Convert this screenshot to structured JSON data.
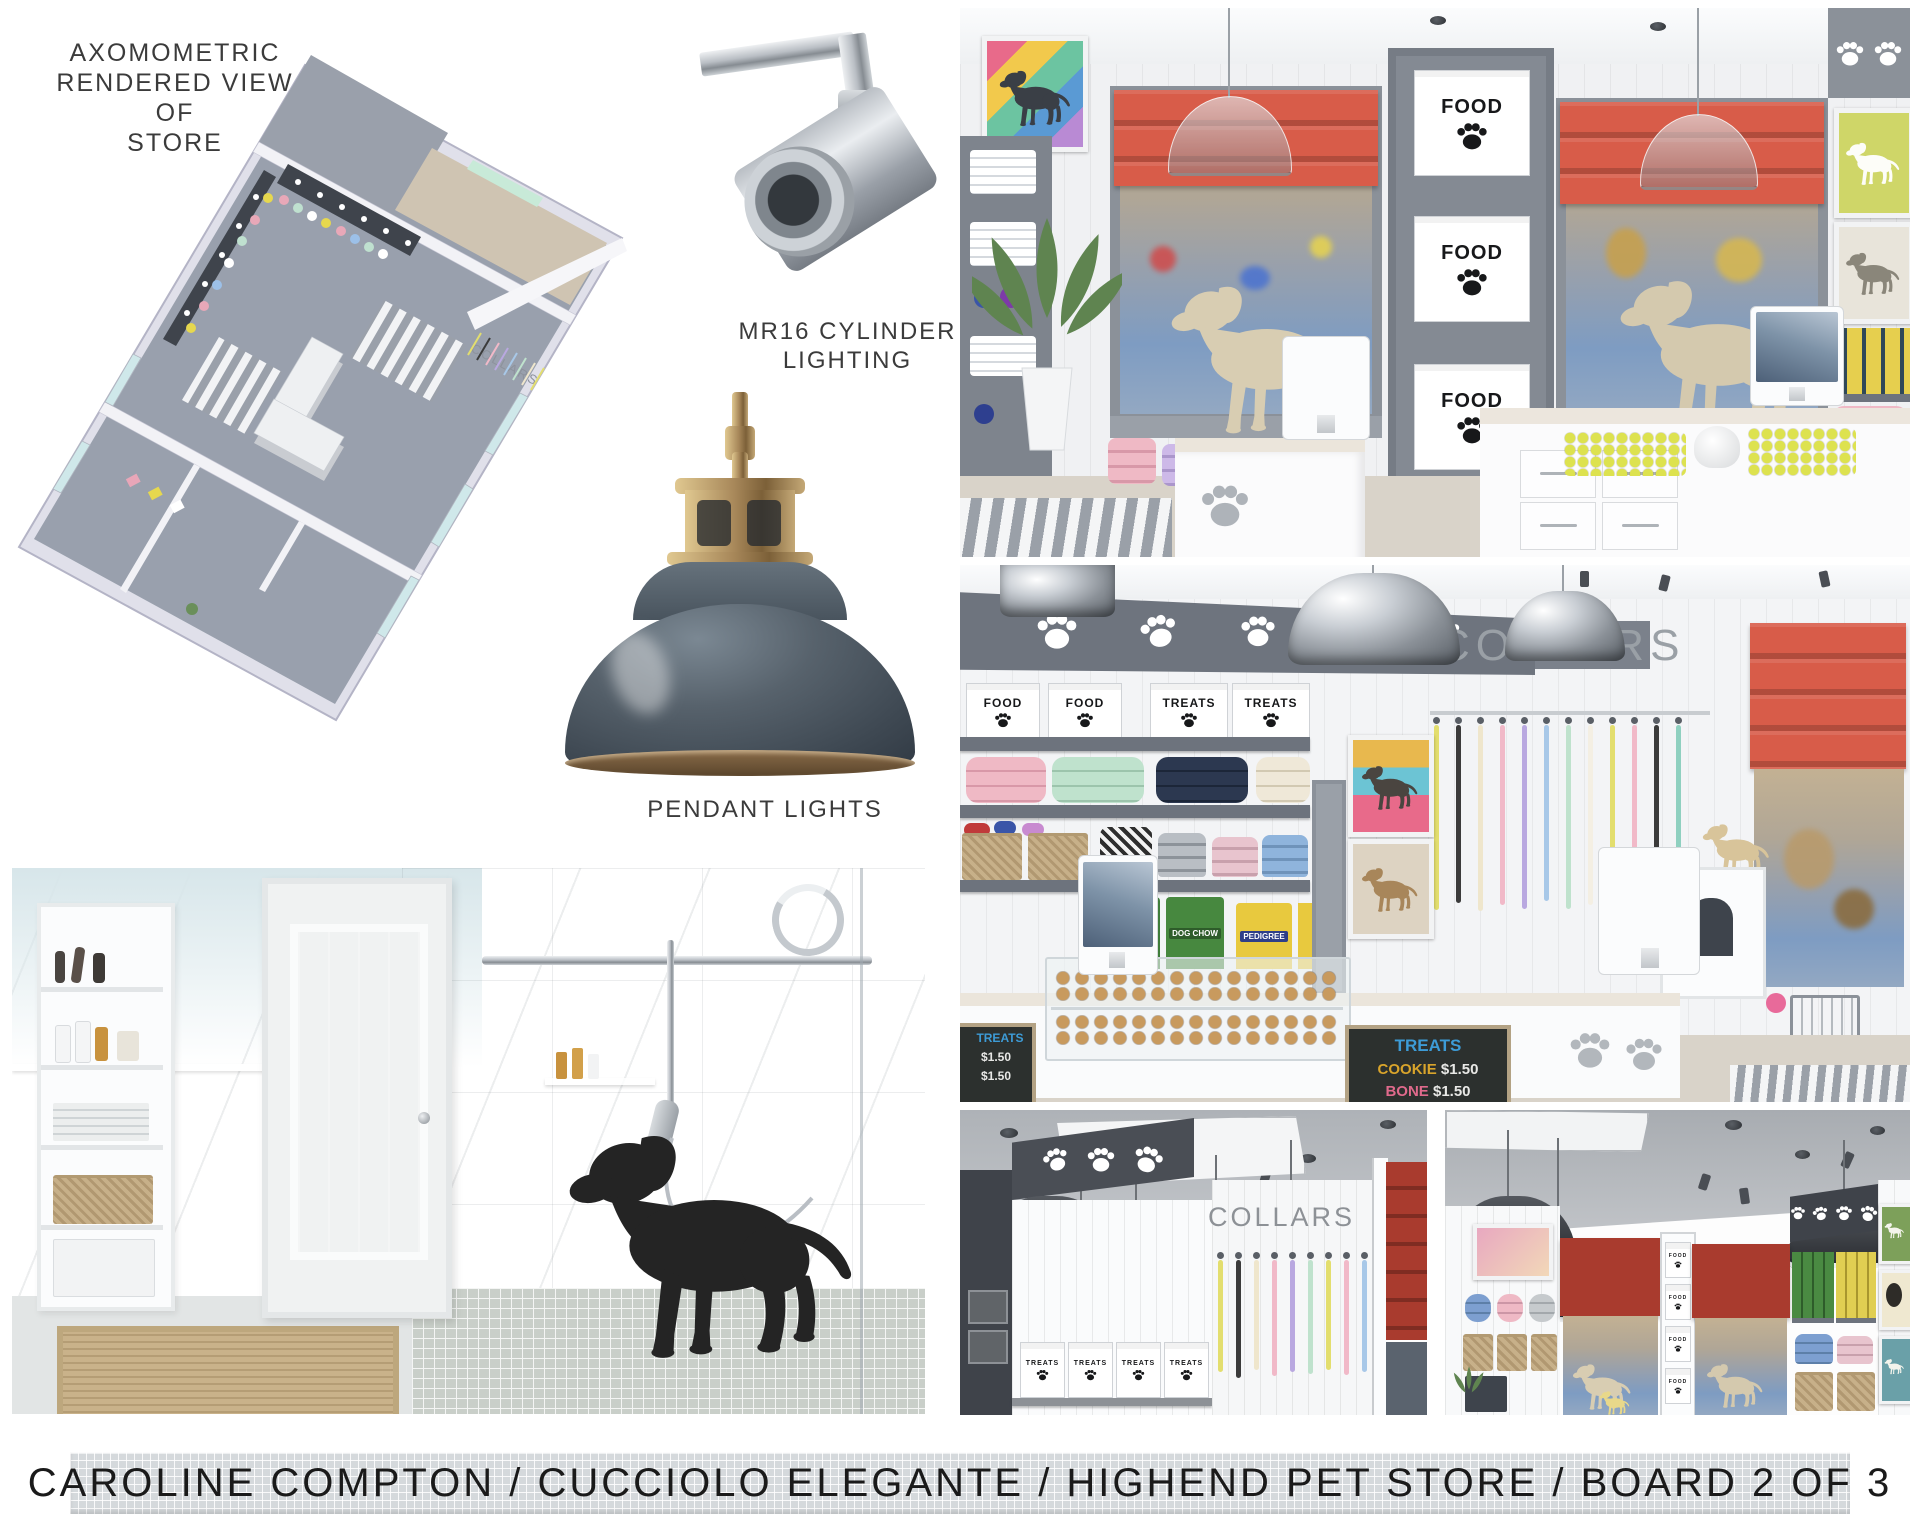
{
  "callouts": {
    "axonometric": "AXOMOMETRIC\nRENDERED VIEW OF\nSTORE",
    "mr16": "MR16 CYLINDER\nLIGHTING",
    "pendant": "PENDANT LIGHTS"
  },
  "banner": {
    "title": "CAROLINE COMPTON / CUCCIOLO ELEGANTE / HIGHEND PET STORE / BOARD 2 OF 3"
  },
  "brand": {
    "sign": "COLLARS"
  },
  "boxes": {
    "food": "FOOD",
    "treats": "TREATS"
  },
  "chalkboard": {
    "heading": "TREATS",
    "line1_item": "COOKIE",
    "line1_price": "$1.50",
    "line2_item": "BONE",
    "line2_price": "$1.50"
  },
  "food_bags": {
    "green": "DOG CHOW",
    "yellow": "PEDIGREE"
  },
  "colors": {
    "accent_red": "#D85C49",
    "dark_red": "#A93B2E",
    "slate_shade": "#47525C",
    "brass": "#A8895B",
    "soffit_gray": "#6E747E",
    "shelf_gray": "#858B94",
    "wall_white": "#F3F4F6",
    "banner_tile": "#D5D9DC",
    "text_black": "#1A1A1A",
    "chalk_blue": "#3D9BD6",
    "chalk_yellow": "#D9A42B",
    "chalk_pink": "#E06A8C",
    "pillow_pink": "#EFB9C5",
    "pillow_mint": "#BFE2CD",
    "pillow_navy": "#2C3850",
    "pillow_cream": "#EFE8D8",
    "tennis_yellow": "#DDE24F",
    "basket_tan": "#C7B089",
    "statue_cream": "#D8CDB2",
    "floor_wood": "#D9D3C9",
    "leash_yellow": "#E3DE6E",
    "leash_black": "#3B3B3B",
    "leash_cream": "#EFE6CC",
    "leash_pink": "#F1B9C8",
    "leash_lavender": "#B9A8E0",
    "leash_blue": "#A8C8E8",
    "leash_mint": "#BFE2CD"
  }
}
